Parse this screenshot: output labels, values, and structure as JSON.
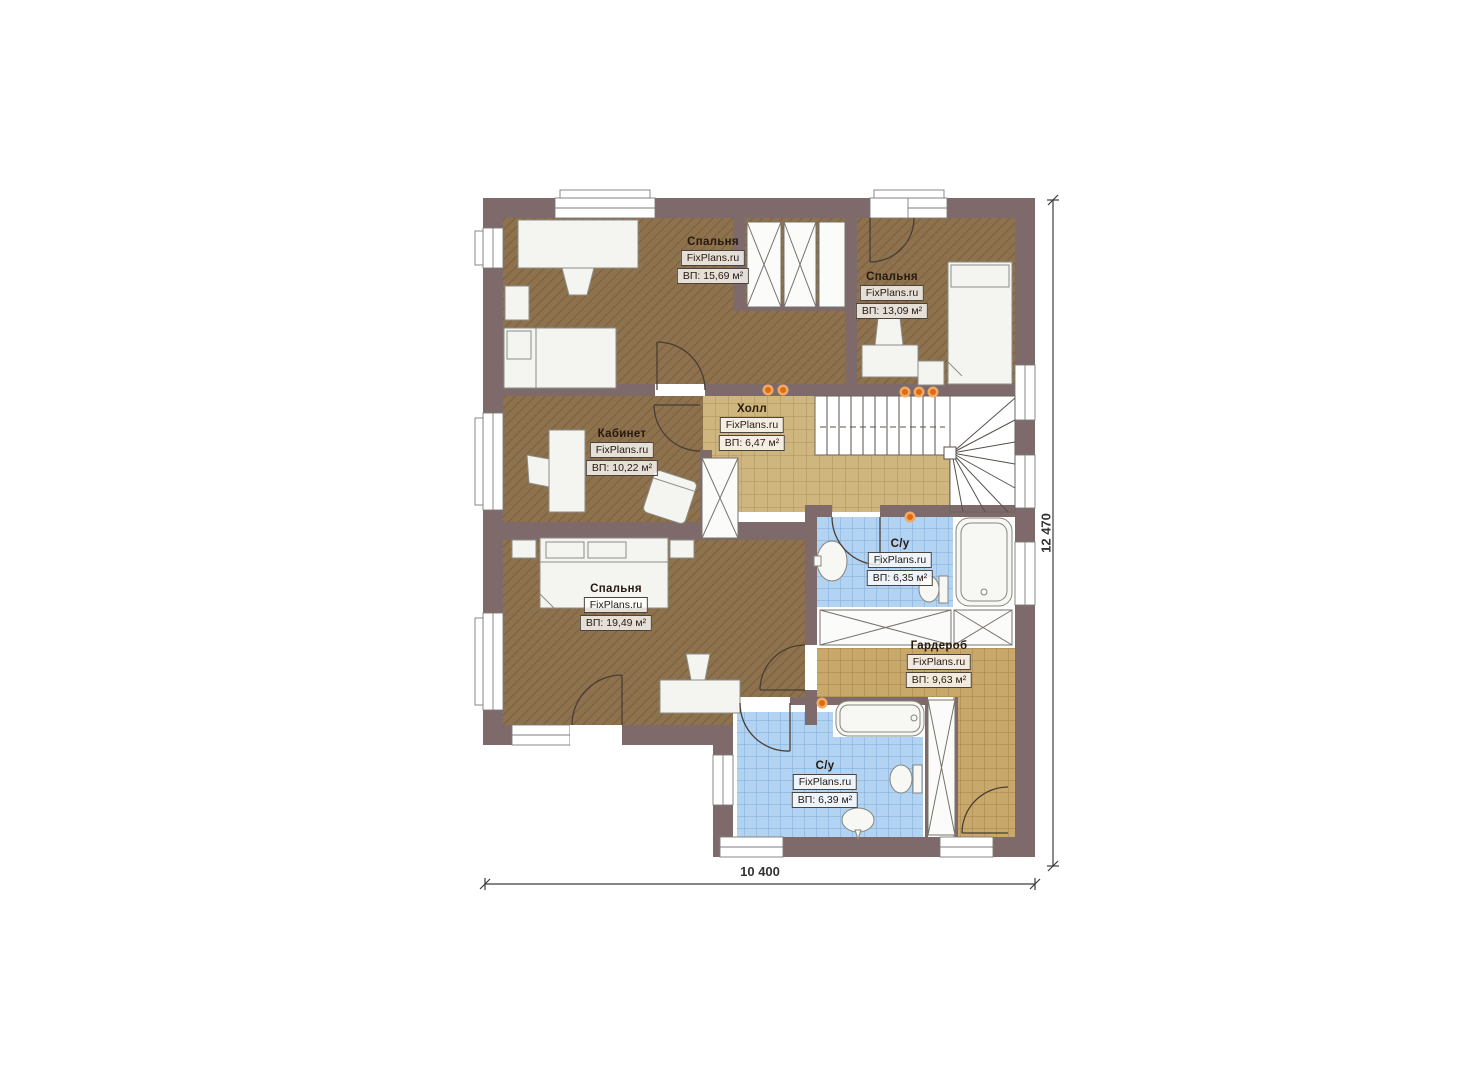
{
  "title": "Floor plan - second level",
  "watermark": "FixPlans.ru",
  "rooms": [
    {
      "id": "bedroom-1",
      "name": "Спальня",
      "area": "ВП: 15,69 м²"
    },
    {
      "id": "bedroom-2",
      "name": "Спальня",
      "area": "ВП: 13,09 м²"
    },
    {
      "id": "office",
      "name": "Кабинет",
      "area": "ВП: 10,22 м²"
    },
    {
      "id": "hall",
      "name": "Холл",
      "area": "ВП: 6,47 м²"
    },
    {
      "id": "bedroom-3",
      "name": "Спальня",
      "area": "ВП: 19,49 м²"
    },
    {
      "id": "bathroom-1",
      "name": "С/у",
      "area": "ВП: 6,35 м²"
    },
    {
      "id": "wardrobe",
      "name": "Гардероб",
      "area": "ВП: 9,63 м²"
    },
    {
      "id": "bathroom-2",
      "name": "С/у",
      "area": "ВП: 6,39 м²"
    }
  ],
  "dimensions": {
    "width_label": "10 400",
    "height_label": "12 470"
  },
  "colors": {
    "wall": "#7e6a6a",
    "bedroom_floor": "#8d724d",
    "hall_tile": "#cfb67e",
    "wardrobe_tile": "#c8a86b",
    "bath_tile": "#b2d3f2",
    "furniture": "#f4f4f1",
    "light_dot": "#dd6b12"
  }
}
